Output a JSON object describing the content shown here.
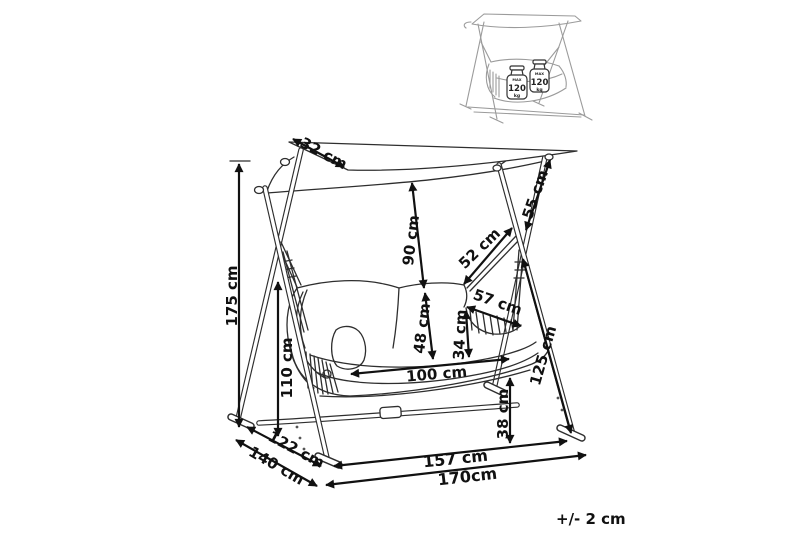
{
  "drawing": {
    "subject": "canopy-swing-seat-dimension-diagram",
    "unit": "cm",
    "tolerance_note": "+/- 2 cm"
  },
  "dimensions": [
    {
      "id": "canopy-side-edge",
      "label": "32 cm",
      "value": 32
    },
    {
      "id": "overall-height",
      "label": "175 cm",
      "value": 175
    },
    {
      "id": "side-frame-height",
      "label": "110 cm",
      "value": 110
    },
    {
      "id": "canopy-to-backrest",
      "label": "90 cm",
      "value": 90
    },
    {
      "id": "backrest-height",
      "label": "48 cm",
      "value": 48
    },
    {
      "id": "hanger-rope-length",
      "label": "52 cm",
      "value": 52
    },
    {
      "id": "upper-leg-segment",
      "label": "55 cm",
      "value": 55
    },
    {
      "id": "armrest-diagonal",
      "label": "57 cm",
      "value": 57
    },
    {
      "id": "armrest-height",
      "label": "34 cm",
      "value": 34
    },
    {
      "id": "seat-width",
      "label": "100 cm",
      "value": 100
    },
    {
      "id": "front-leg-length",
      "label": "125 cm",
      "value": 125
    },
    {
      "id": "seat-ground-clearance",
      "label": "38 cm",
      "value": 38
    },
    {
      "id": "inner-base-width",
      "label": "157 cm",
      "value": 157
    },
    {
      "id": "overall-base-width",
      "label": "170cm",
      "value": 170
    },
    {
      "id": "base-depth-inner",
      "label": "122 cm",
      "value": 122
    },
    {
      "id": "base-depth-outer",
      "label": "140 cm",
      "value": 140
    }
  ],
  "inset": {
    "weight_tags": [
      {
        "max": "MAX",
        "value": "120",
        "unit": "kg"
      },
      {
        "max": "MAX",
        "value": "120",
        "unit": "kg"
      }
    ]
  }
}
